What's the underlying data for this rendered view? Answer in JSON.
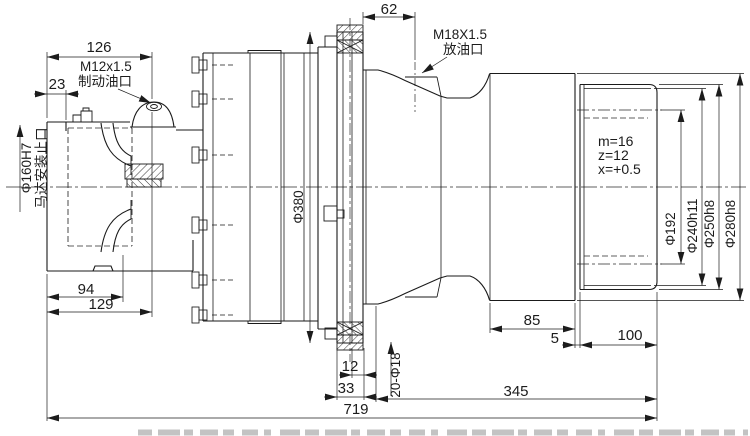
{
  "drawing": {
    "ports": {
      "brake_thread": "M12x1.5",
      "brake_label": "制动油口",
      "drain_thread": "M18X1.5",
      "drain_label": "放油口"
    },
    "motor_mount": {
      "diameter": "Φ160H7",
      "label": "马达安装止口"
    },
    "gear_spec": {
      "module": "m=16",
      "teeth": "z=12",
      "shift": "x=+0.5"
    },
    "diameters": {
      "housing": "Φ380",
      "pitch": "Φ192",
      "d240": "Φ240h11",
      "d250": "Φ250h8",
      "d280": "Φ280h8"
    },
    "holes": "20-Φ18",
    "lengths": {
      "l126": "126",
      "l23": "23",
      "l62": "62",
      "l94": "94",
      "l129": "129",
      "l12": "12",
      "l33": "33",
      "l719": "719",
      "l85": "85",
      "l5": "5",
      "l100": "100",
      "l345": "345"
    }
  }
}
